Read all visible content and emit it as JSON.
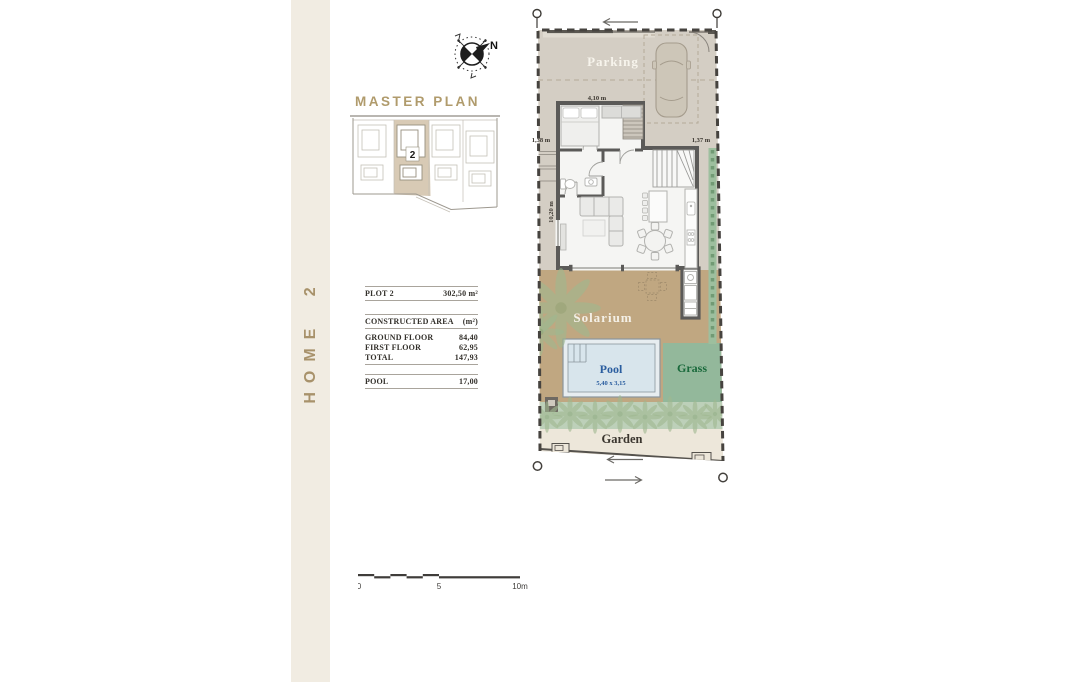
{
  "strip": {
    "label": "HOME 2"
  },
  "master_plan": {
    "heading": "MASTER PLAN",
    "plot_number": "2"
  },
  "compass": {
    "north": "N"
  },
  "info_table": {
    "plot": {
      "label": "PLOT 2",
      "value": "302,50 m²"
    },
    "constructed": {
      "label": "CONSTRUCTED AREA",
      "unit": "(m²)"
    },
    "rows": [
      {
        "label": "GROUND FLOOR",
        "value": "84,40"
      },
      {
        "label": "FIRST FLOOR",
        "value": "62,95"
      },
      {
        "label": "TOTAL",
        "value": "147,93"
      }
    ],
    "pool": {
      "label": "POOL",
      "value": "17,00"
    }
  },
  "floor_plan": {
    "areas": {
      "parking": "Parking",
      "solarium": "Solarium",
      "pool": "Pool",
      "pool_size": "5,40 x 3,15",
      "grass": "Grass",
      "garden": "Garden"
    },
    "dimensions": {
      "bedroom_width": "4,10 m",
      "left_setback": "1,38 m",
      "right_setback": "1,37 m",
      "side_length": "10,20 m"
    }
  },
  "scale_bar": {
    "start": "0",
    "mid": "5",
    "end": "10m"
  },
  "colors": {
    "accent_gold": "#ab9468",
    "plan_beige": "#d4cec4",
    "deck_tan": "#c0a781",
    "pool_water": "#d8e5ec",
    "pool_text": "#2a5d9f",
    "grass_green": "#93b89b",
    "grass_text": "#19693b",
    "strip_bg": "#f1ece2"
  }
}
